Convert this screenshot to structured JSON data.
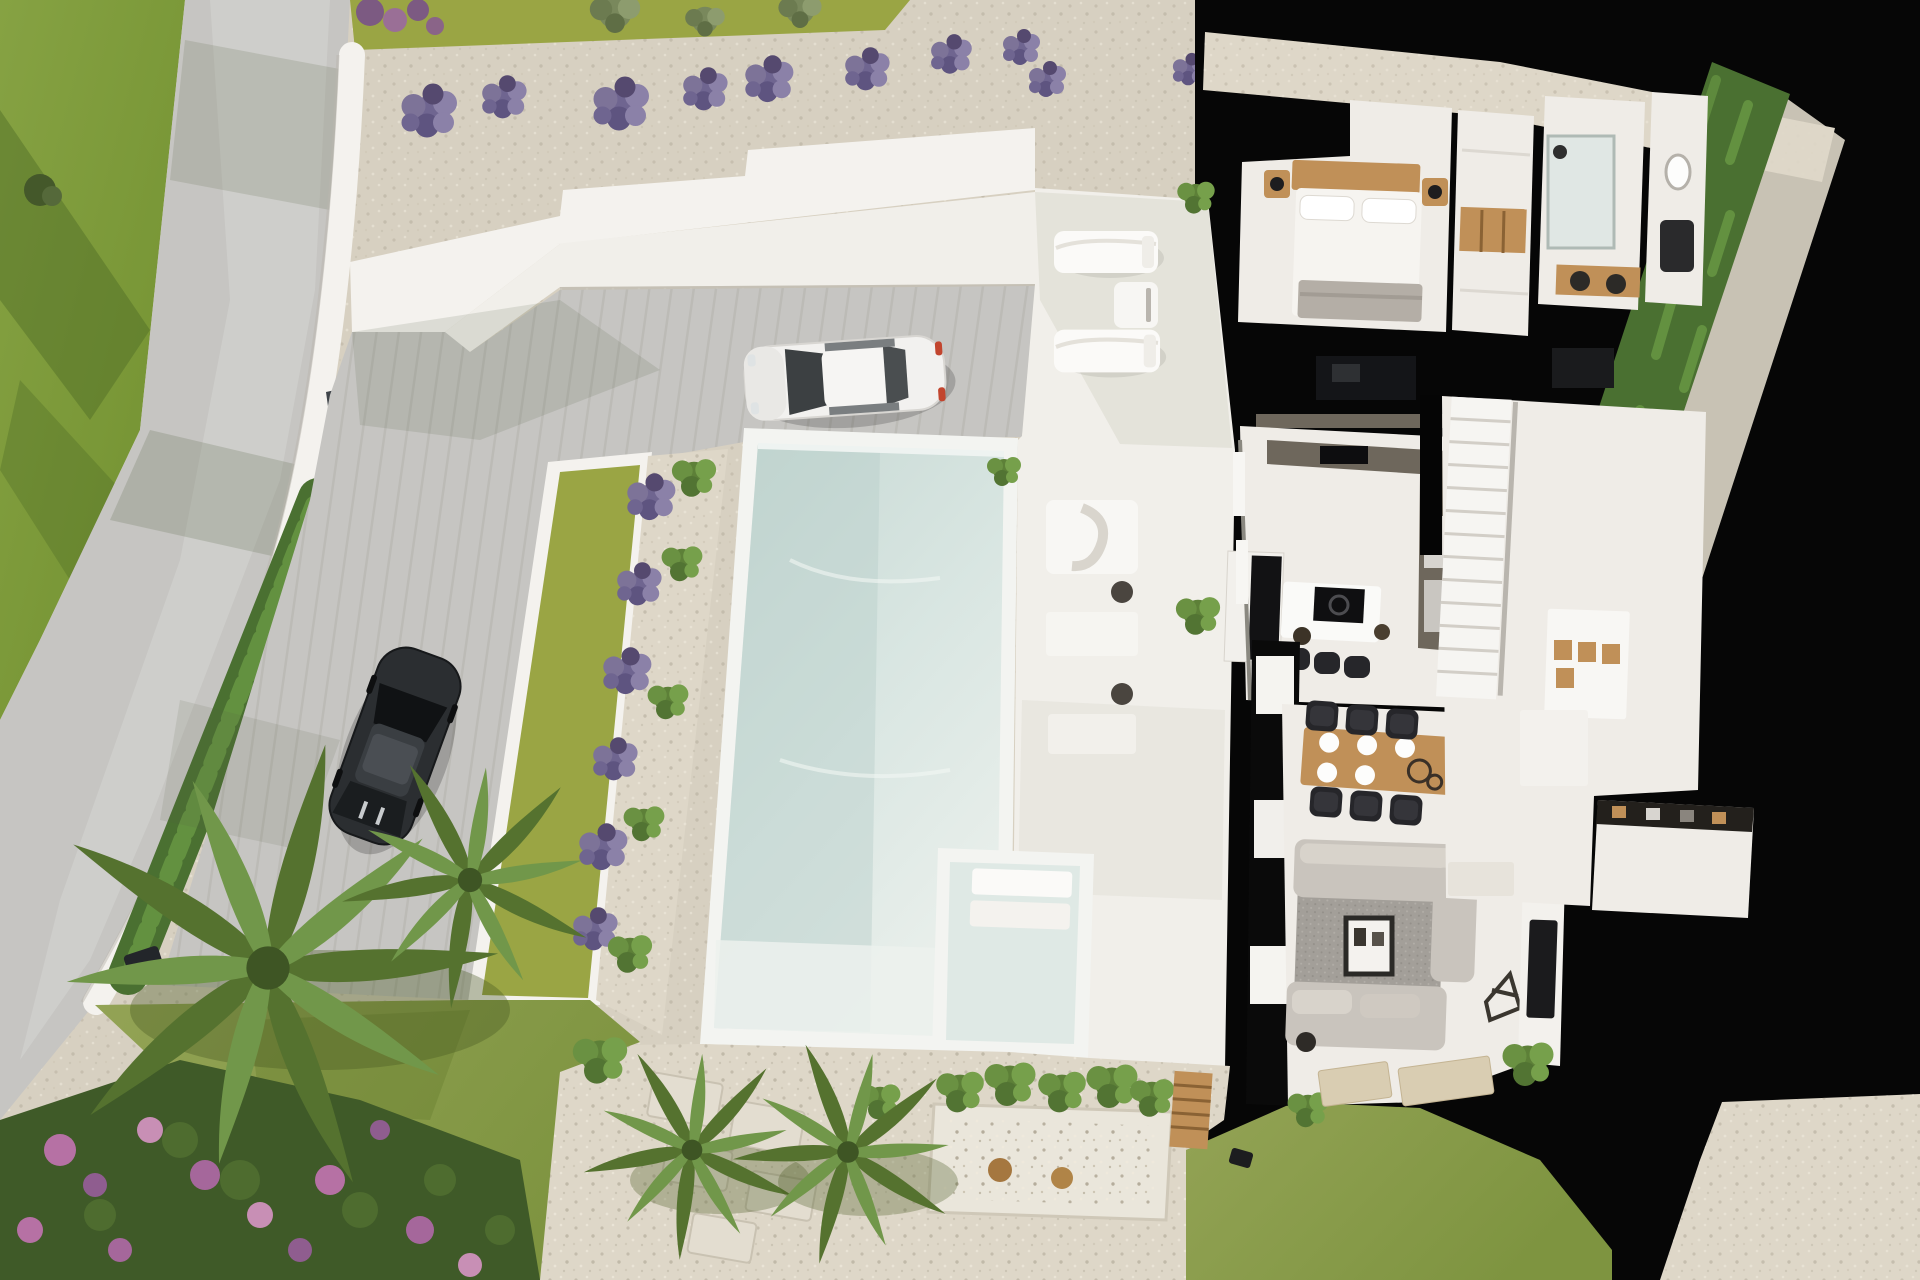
{
  "image": {
    "kind": "3d-aerial-architectural-render",
    "subject": "top-down cutaway view of a modern white villa with infinity pool, driveway, two parked cars and landscaped garden",
    "visible_text": []
  },
  "palette": {
    "grassTop": "#7e9a3c",
    "grassOlive": "#9aa544",
    "grassBtm": "#8a9c49",
    "road": "#c6c5c2",
    "gravel": "#d7d0c1",
    "walkway": "#ded7c8",
    "wallWhite": "#f4f2ee",
    "gateDark": "#3f4449",
    "hedge": "#4a7031",
    "hedgeLight": "#639140",
    "deck": "#f1efea",
    "floor": "#efece7",
    "cutBlack": "#060606",
    "counter": "#6e675c",
    "wood": "#c09058",
    "sofa": "#c9c4bd",
    "rug": "#a39f99",
    "chairDark": "#26262a",
    "carWhite": "#f2f1ef",
    "carDark": "#2b2e31",
    "matBeige": "#d9cdb2",
    "poolRim": "#f3f4f1",
    "poolDeep": "#c6d8d3",
    "poolLight": "#e4ede9",
    "lavender": "#6f6590",
    "flowerPink": "#b671a4"
  },
  "scene": {
    "outdoor": [
      {
        "name": "road",
        "label": "curved access road, upper left"
      },
      {
        "name": "upper-lawn",
        "label": "green lawn with tree shadows, top left"
      },
      {
        "name": "boundary-wall",
        "label": "white curved boundary wall"
      },
      {
        "name": "entrance-gate",
        "label": "dark grey entrance gate panel"
      },
      {
        "name": "left-hedge",
        "label": "hedge row inside boundary wall"
      },
      {
        "name": "gravel-bank",
        "label": "gravel bank with lavender bushes along top"
      },
      {
        "name": "lavender-row",
        "label": "row of lavender shrubs",
        "count": 10
      },
      {
        "name": "retaining-steps",
        "label": "white stepped retaining walls"
      },
      {
        "name": "driveway",
        "label": "grey paved driveway"
      },
      {
        "name": "white-car",
        "label": "white coupe parked facing the pool"
      },
      {
        "name": "black-car",
        "label": "black car parked near the gate"
      },
      {
        "name": "planter-lawn-strip",
        "label": "narrow lawn strip beside pool"
      },
      {
        "name": "planter-gravel-strip",
        "label": "gravel strip with alternating lavender and green shrubs"
      },
      {
        "name": "swimming-pool",
        "label": "large rectangular infinity pool"
      },
      {
        "name": "kids-pool",
        "label": "small attached plunge pool with two white pads"
      },
      {
        "name": "pool-deck",
        "label": "white pool deck"
      },
      {
        "name": "sun-loungers",
        "label": "pair of white sun loungers with side table",
        "count": 2
      },
      {
        "name": "lounge-chair",
        "label": "white outdoor lounge chair with throw"
      },
      {
        "name": "garden-lawn",
        "label": "south garden lawn"
      },
      {
        "name": "flower-bed",
        "label": "pink and purple flower bed, bottom left"
      },
      {
        "name": "palm-tree",
        "label": "large palm tree",
        "count": 1
      },
      {
        "name": "fan-palms",
        "label": "small fan palms",
        "count": 2
      },
      {
        "name": "gravel-path",
        "label": "gravel path with stepping stones"
      },
      {
        "name": "planter-box",
        "label": "raised planter with shrubs and wooden screen"
      },
      {
        "name": "right-hedge",
        "label": "tall hedge strip along right boundary"
      },
      {
        "name": "gravel-corner",
        "label": "gravel patch, bottom right corner"
      }
    ],
    "house": [
      {
        "name": "cutaway-plan",
        "label": "roofless cutaway floor plan with black section-cut walls"
      },
      {
        "name": "bedroom",
        "label": "bedroom with double bed, nightstands and lamps"
      },
      {
        "name": "wardrobe",
        "label": "built-in wardrobe with wooden shelf"
      },
      {
        "name": "shower-room",
        "label": "bathroom with walk-in shower"
      },
      {
        "name": "vanity-bathroom",
        "label": "bathroom with twin-sink wooden vanity"
      },
      {
        "name": "kitchen",
        "label": "U-shaped dark kitchen with island and hob"
      },
      {
        "name": "bar-stools",
        "label": "bar stools at island",
        "count": 3
      },
      {
        "name": "dining-table",
        "label": "wooden dining table with six black chairs and place settings",
        "chairs": 6
      },
      {
        "name": "staircase",
        "label": "white staircase to lower level"
      },
      {
        "name": "hall-sideboard",
        "label": "hallway sideboard with wooden niches"
      },
      {
        "name": "living-room",
        "label": "living room with two facing grey sofas"
      },
      {
        "name": "area-rug",
        "label": "grey textured area rug"
      },
      {
        "name": "fireplace-console",
        "label": "central fireplace / display console"
      },
      {
        "name": "tv-panel",
        "label": "wall-mounted TV panel"
      },
      {
        "name": "storage-room",
        "label": "storage room with dark shelving, lower right"
      },
      {
        "name": "glass-doors",
        "label": "sliding glass door wall to the terrace"
      },
      {
        "name": "terrace-mats",
        "label": "beige outdoor mats",
        "count": 2
      }
    ]
  }
}
